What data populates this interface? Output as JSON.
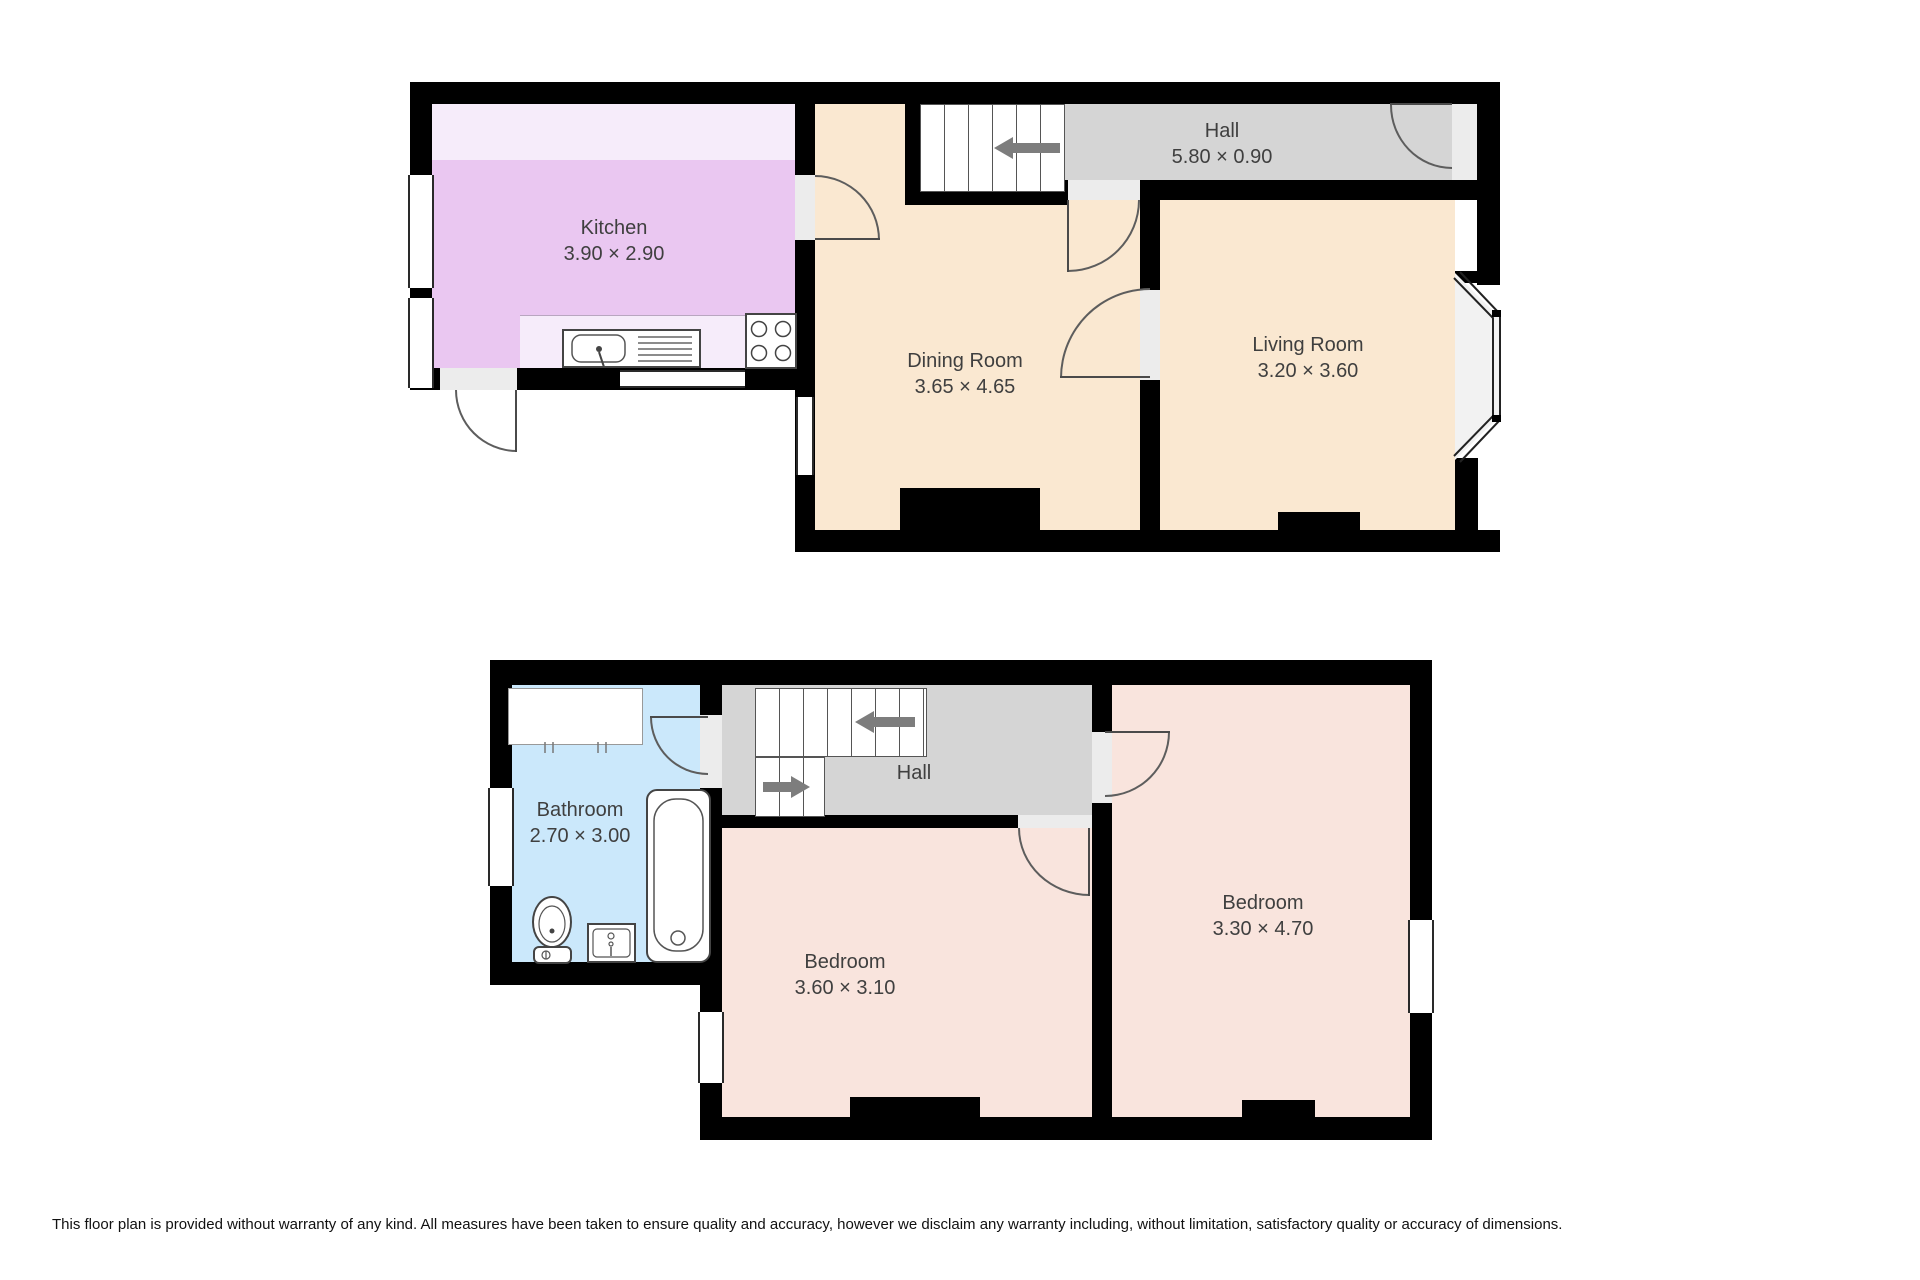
{
  "colors": {
    "wall": "#000000",
    "room_cream": "#FAE8D1",
    "kitchen_purple": "#EAC7F1",
    "kitchen_counter_light": "#F6ECFA",
    "hall_gray": "#D5D5D5",
    "door_opening": "#ECECEC",
    "bathroom_blue": "#CBE8FB",
    "bedroom_pink": "#F9E4DD",
    "stair_arrow_gray": "#7d7d7d"
  },
  "ground_floor": {
    "kitchen": {
      "name": "Kitchen",
      "dims": "3.90 × 2.90"
    },
    "dining": {
      "name": "Dining Room",
      "dims": "3.65 × 4.65"
    },
    "living": {
      "name": "Living Room",
      "dims": "3.20 × 3.60"
    },
    "hall": {
      "name": "Hall",
      "dims": "5.80 × 0.90"
    }
  },
  "first_floor": {
    "bathroom": {
      "name": "Bathroom",
      "dims": "2.70 × 3.00"
    },
    "hall": {
      "name": "Hall"
    },
    "bedroom_small": {
      "name": "Bedroom",
      "dims": "3.60 × 3.10"
    },
    "bedroom_large": {
      "name": "Bedroom",
      "dims": "3.30 × 4.70"
    }
  },
  "disclaimer": "This floor plan is provided without warranty of any kind. All measures have been taken to ensure quality and accuracy, however we disclaim any warranty including, without limitation, satisfactory quality or accuracy of dimensions."
}
